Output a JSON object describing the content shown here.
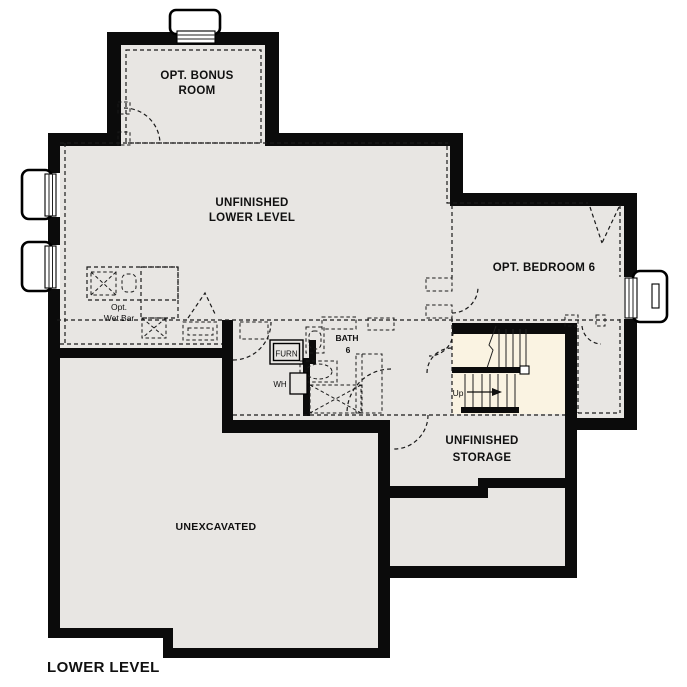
{
  "plan_title": "LOWER LEVEL",
  "colors": {
    "background": "#ffffff",
    "floor": "#e8e6e3",
    "stair_floor": "#faf3e2",
    "wall": "#0b0b0b",
    "line": "#1a1a1a"
  },
  "rooms": {
    "bonus_room": {
      "line1": "OPT. BONUS",
      "line2": "ROOM"
    },
    "lower_level": {
      "line1": "UNFINISHED",
      "line2": "LOWER LEVEL"
    },
    "bedroom_6": {
      "label": "OPT. BEDROOM 6"
    },
    "bath_6": {
      "line1": "BATH",
      "line2": "6"
    },
    "unfinished_storage": {
      "line1": "UNFINISHED",
      "line2": "STORAGE"
    },
    "unexcavated": {
      "label": "UNEXCAVATED"
    }
  },
  "annotations": {
    "wet_bar": {
      "line1": "Opt.",
      "line2": "Wet Bar"
    },
    "furnace": "FURN",
    "water_heater": "WH",
    "stairs_up": "Up"
  }
}
